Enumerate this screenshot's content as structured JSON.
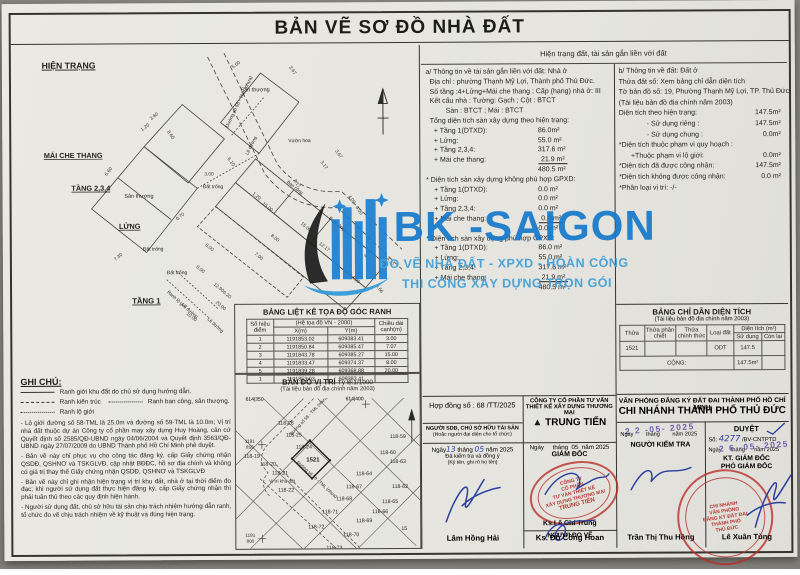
{
  "title": "BẢN VẼ SƠ ĐỒ NHÀ ĐẤT",
  "colors": {
    "paper": "#eae9e3",
    "ink": "#24241f",
    "watermark_blue": "#1679cc",
    "watermark_light": "#3f9ed8",
    "stamp_red": "#ba2a26",
    "pen_blue": "#2b3f9e",
    "date_purple": "#6e63b0"
  },
  "watermark": {
    "brand": "BK -SAIGON",
    "line1": "ĐO VẼ NHÀ ĐẤT - XPXD - HOÀN CÔNG",
    "line2": "THI CÔNG XÂY DỰNG TRỌN GÓI"
  },
  "info_header": "Hiện trạng đất, tài sản gắn liền với đất",
  "info_a": {
    "lines": [
      {
        "t": "a/ Thông tin về tài sản gắn liền với đất: Nhà ở",
        "ind": 0
      },
      {
        "t": "Địa chỉ : phường Thạnh Mỹ Lợi, Thành phố Thủ Đức.",
        "ind": 1
      },
      {
        "t": "Số tầng :4+Lửng+Mái che thang ; Cấp (hạng) nhà ở:  III",
        "ind": 1
      },
      {
        "t": "Kết cấu nhà : Tường:  Gạch    ; Cột :  BTCT",
        "ind": 1
      },
      {
        "t": "Sàn :  BTCT   ; Mái :  BTCT",
        "ind": 5
      },
      {
        "t": "Tổng diện tích sàn xây dựng theo hiện trạng:",
        "ind": 1
      },
      {
        "t": "+ Tầng 1(DTXD):",
        "v": "86.0m²",
        "ind": 2
      },
      {
        "t": "+ Lửng:",
        "v": "55.0 m²",
        "ind": 2
      },
      {
        "t": "+ Tầng 2,3,4:",
        "v": "317.6 m²",
        "ind": 2
      },
      {
        "t": "+ Mái che thang:",
        "v": "21.9 m²",
        "ind": 2,
        "vu": 1
      },
      {
        "t": "",
        "v": "480.5 m²",
        "ind": 2
      },
      {
        "t": "* Diện tích sàn xây dựng không phù hợp GPXD:",
        "ind": 0
      },
      {
        "t": "+ Tầng 1(DTXD):",
        "v": "0.0 m²",
        "ind": 2
      },
      {
        "t": "+ Lửng:",
        "v": "0.0 m²",
        "ind": 2
      },
      {
        "t": "+ Tầng 2,3,4:",
        "v": "0.0 m²",
        "ind": 2
      },
      {
        "t": "+ Mái che thang:",
        "v": "0.0 m²",
        "ind": 2,
        "vu": 1
      },
      {
        "t": "",
        "v": "0.0 m²",
        "ind": 2
      },
      {
        "t": "* Diện tích sàn xây dựng phù hợp GPXD:",
        "ind": 0
      },
      {
        "t": "+ Tầng 1(DTXD):",
        "v": "86.0 m²",
        "ind": 2
      },
      {
        "t": "+ Lửng:",
        "v": "55.0 m²",
        "ind": 2
      },
      {
        "t": "+ Tầng 2,3,4:",
        "v": "317.6 m²",
        "ind": 2
      },
      {
        "t": "+ Mái che thang:",
        "v": "21.9 m²",
        "ind": 2,
        "vu": 1
      },
      {
        "t": "",
        "v": "480.5 m²",
        "ind": 2
      }
    ]
  },
  "info_b": {
    "lines": [
      {
        "t": "b/ Thông tin về đất: Đất ở",
        "ind": 0
      },
      {
        "t": "Thửa đất số:  Xem bảng chỉ dẫn diện tích",
        "ind": 0
      },
      {
        "t": "Tờ bản đồ số:  19, Phường Thạnh Mỹ Lợi, TP. Thủ Đức.",
        "ind": 0
      },
      {
        "t": "(Tài liệu bản đồ địa chính năm 2003)",
        "ind": 0
      },
      {
        "t": "Diện tích theo hiện trạng:",
        "v": "147.5m²",
        "ind": 0
      },
      {
        "t": "- Sử dụng riêng :",
        "v": "147.5m²",
        "ind": 7
      },
      {
        "t": "- Sử dụng chung :",
        "v": "0.0m²",
        "ind": 7
      },
      {
        "t": "*Diện tích thuộc phạm vi quy hoạch :",
        "ind": 0
      },
      {
        "t": "+Thuộc phạm vi lộ giới:",
        "v": "0.0m²",
        "ind": 3
      },
      {
        "t": "*Diện tích đã được công nhận:",
        "v": "147.5m²",
        "ind": 0
      },
      {
        "t": "*Diện tích không được công nhận:",
        "v": "0.0 m²",
        "ind": 0
      },
      {
        "t": "*Phân loại vị trí:  -/-",
        "ind": 0
      }
    ]
  },
  "plan": {
    "heading": "HIỆN TRẠNG",
    "labels": [
      {
        "t": "HIỆN TRẠNG",
        "x": 14,
        "y": 56,
        "s": 9.5,
        "b": 1,
        "u": 1
      },
      {
        "t": "Sân thượng",
        "x": 232,
        "y": 82,
        "s": 6
      },
      {
        "t": "Sân thượng",
        "x": 104,
        "y": 198,
        "s": 6
      },
      {
        "t": "MÁI CHE THANG",
        "x": 16,
        "y": 154,
        "s": 8,
        "b": 1,
        "u": 1
      },
      {
        "t": "TẦNG 2,3,4",
        "x": 46,
        "y": 190,
        "s": 8,
        "b": 1,
        "u": 1
      },
      {
        "t": "LỬNG",
        "x": 98,
        "y": 232,
        "s": 8,
        "b": 1,
        "u": 1
      },
      {
        "t": "TẦNG 1",
        "x": 112,
        "y": 314,
        "s": 8.5,
        "b": 1,
        "u": 1
      },
      {
        "t": "Đất trống",
        "x": 190,
        "y": 188,
        "s": 5.5
      },
      {
        "t": "Đất trống",
        "x": 124,
        "y": 256,
        "s": 5.5
      },
      {
        "t": "Đất trống",
        "x": 150,
        "y": 282,
        "s": 5.5
      },
      {
        "t": "Vườn hoa",
        "x": 284,
        "y": 138,
        "s": 5.5
      },
      {
        "t": "Đường số 58 - TML (nhựa)",
        "x": 218,
        "y": 122,
        "s": 5.2,
        "r": -64
      },
      {
        "t": "Lề đường",
        "x": 240,
        "y": 152,
        "s": 5,
        "r": -64
      },
      {
        "t": "Ban công",
        "x": 282,
        "y": 182,
        "s": 5,
        "r": 40
      },
      {
        "t": "Ban công",
        "x": 328,
        "y": 222,
        "s": 5,
        "r": 40
      },
      {
        "t": "Ranh lộ giới",
        "x": 150,
        "y": 302,
        "s": 5,
        "r": 42
      },
      {
        "t": "Lề đường",
        "x": 166,
        "y": 316,
        "s": 5,
        "r": 42
      },
      {
        "t": "Lề đường",
        "x": 194,
        "y": 332,
        "s": 5,
        "r": 42
      }
    ],
    "dims": [
      {
        "t": "5.00",
        "x": 228,
        "y": 54,
        "r": -35
      },
      {
        "t": "3.67",
        "x": 288,
        "y": 60,
        "r": 55
      },
      {
        "t": "3.60",
        "x": 138,
        "y": 110,
        "r": -38
      },
      {
        "t": "1.20",
        "x": 128,
        "y": 122,
        "r": -38
      },
      {
        "t": "8.60",
        "x": 154,
        "y": 130,
        "r": 55
      },
      {
        "t": "6.60",
        "x": 88,
        "y": 170,
        "r": -52
      },
      {
        "t": "6.10",
        "x": 220,
        "y": 160,
        "r": 55
      },
      {
        "t": "3.00",
        "x": 197,
        "y": 174,
        "r": 0
      },
      {
        "t": "2.17",
        "x": 292,
        "y": 184,
        "r": 55
      },
      {
        "t": "0.70",
        "x": 166,
        "y": 220,
        "r": -38
      },
      {
        "t": "7.30",
        "x": 98,
        "y": 264,
        "r": -40
      },
      {
        "t": "1.20",
        "x": 248,
        "y": 198,
        "r": 40
      },
      {
        "t": "15.00",
        "x": 260,
        "y": 210,
        "r": 40
      },
      {
        "t": "3.17",
        "x": 322,
        "y": 164,
        "r": 55
      },
      {
        "t": "3.67",
        "x": 338,
        "y": 152,
        "r": 55
      },
      {
        "t": "4.00",
        "x": 352,
        "y": 202,
        "r": 55
      },
      {
        "t": "6.00",
        "x": 360,
        "y": 214,
        "r": 55
      },
      {
        "t": "8.00",
        "x": 268,
        "y": 244,
        "r": 40
      },
      {
        "t": "7.00",
        "x": 250,
        "y": 264,
        "r": 40
      },
      {
        "t": "12.17",
        "x": 322,
        "y": 254,
        "r": 40
      },
      {
        "t": "15.00",
        "x": 302,
        "y": 232,
        "r": 40
      },
      {
        "t": "4.40",
        "x": 372,
        "y": 262,
        "r": -40
      },
      {
        "t": "3.12",
        "x": 394,
        "y": 270,
        "r": 55
      },
      {
        "t": "6.66",
        "x": 382,
        "y": 300,
        "r": 55
      },
      {
        "t": "4.00",
        "x": 356,
        "y": 290,
        "r": 40
      },
      {
        "t": "8.00",
        "x": 196,
        "y": 254,
        "r": 40
      },
      {
        "t": "8.00",
        "x": 186,
        "y": 278,
        "r": 40
      },
      {
        "t": "12.90",
        "x": 206,
        "y": 298,
        "r": 40
      },
      {
        "t": "10.00",
        "x": 176,
        "y": 330,
        "r": 40
      },
      {
        "t": "6.20",
        "x": 215,
        "y": 306,
        "r": 40
      },
      {
        "t": "20.00",
        "x": 208,
        "y": 318,
        "r": 40
      }
    ]
  },
  "coord_table": {
    "title": "BẢNG LIỆT KÊ TỌA ĐỘ GÓC RANH",
    "col_point": "Số hiệu điểm",
    "col_sys": "(Hệ tọa độ VN - 2000)",
    "col_x": "X(m)",
    "col_y": "Y(m)",
    "col_len": "Chiều dài cạnh(m)",
    "rows": [
      [
        "1",
        "1191853.02",
        "609383.41",
        "3.00"
      ],
      [
        "2",
        "1191850.84",
        "609385.47",
        "7.07"
      ],
      [
        "3",
        "1191843.78",
        "609385.27",
        "15.00"
      ],
      [
        "4",
        "1191833.47",
        "609374.37",
        "8.00"
      ],
      [
        "5",
        "1191839.28",
        "609368.88",
        "20.00"
      ],
      [
        "1",
        "1191853.02",
        "609383.41",
        ""
      ]
    ]
  },
  "map": {
    "title": "BẢN ĐỒ VỊ TRÍ",
    "scale": "Tỷ lệ:1/1000",
    "subtitle": "(Tài liệu bản đồ địa chính năm 2003)",
    "ref_left": "614|350",
    "ref_right": "614|400",
    "labels": [
      {
        "t": "118-26",
        "x": 272,
        "y": 410
      },
      {
        "t": "118-25",
        "x": 280,
        "y": 422
      },
      {
        "t": "118-24",
        "x": 290,
        "y": 434
      },
      {
        "t": "1521",
        "x": 299,
        "y": 447,
        "b": 1,
        "s": 6
      },
      {
        "t": "118-19",
        "x": 238,
        "y": 443
      },
      {
        "t": "118-20",
        "x": 254,
        "y": 451
      },
      {
        "t": "118-21",
        "x": 266,
        "y": 460
      },
      {
        "t": "Vị trí khu đất",
        "x": 268,
        "y": 468,
        "s": 4.6
      },
      {
        "t": "118-22",
        "x": 272,
        "y": 477
      },
      {
        "t": "118-59",
        "x": 384,
        "y": 424
      },
      {
        "t": "118-60",
        "x": 374,
        "y": 440
      },
      {
        "t": "118-63",
        "x": 384,
        "y": 449
      },
      {
        "t": "118-64",
        "x": 350,
        "y": 461
      },
      {
        "t": "118-67",
        "x": 340,
        "y": 474
      },
      {
        "t": "118-68",
        "x": 330,
        "y": 486
      },
      {
        "t": "118-62",
        "x": 386,
        "y": 474
      },
      {
        "t": "118-65",
        "x": 376,
        "y": 489
      },
      {
        "t": "118-66",
        "x": 366,
        "y": 499
      },
      {
        "t": "118-69",
        "x": 350,
        "y": 508
      },
      {
        "t": "118-71",
        "x": 316,
        "y": 499
      },
      {
        "t": "118-72",
        "x": 302,
        "y": 514
      },
      {
        "t": "118-70",
        "x": 337,
        "y": 522
      },
      {
        "t": "118-73",
        "x": 320,
        "y": 535
      },
      {
        "t": "15",
        "x": 390,
        "y": 516
      },
      {
        "t": "1191",
        "x": 236,
        "y": 428,
        "s": 4.6
      },
      {
        "t": "850",
        "x": 236,
        "y": 434,
        "s": 4.6
      },
      {
        "t": "1191",
        "x": 236,
        "y": 522,
        "s": 4.6
      },
      {
        "t": "800",
        "x": 236,
        "y": 528,
        "s": 4.6
      },
      {
        "t": "Đường số 58 - TML (nhựa)",
        "x": 296,
        "y": 402,
        "s": 4.4,
        "r": -46
      },
      {
        "t": "Đường số 59 - TML (nhựa)",
        "x": 302,
        "y": 466,
        "s": 4.4,
        "r": 43
      }
    ]
  },
  "notes": {
    "heading": "GHI CHÚ:",
    "legend": [
      {
        "label": "Ranh giới khu đất do chủ sử dụng hướng dẫn."
      },
      {
        "label": "Ranh kiến trúc"
      },
      {
        "label": "Ranh ban công, sân thượng."
      },
      {
        "label": "Ranh lộ giới"
      }
    ],
    "paragraphs": [
      "- Lộ giới đường số 58-TML là 25.0m và đường số 59-TML là 10.0m; Vị trí nhà đất thuộc dự án Công ty cổ phần may xây dựng Huy Hoàng, căn cứ Quyết định số 2585/QĐ-UBND ngày 04/06/2004 và Quyết định 3563/QĐ-UBND ngày 27/07/2009 do UBND Thành phố Hồ Chí Minh phê duyệt.",
      "- Bản vẽ này chỉ phục vụ cho công tác đăng ký, cấp Giấy chứng nhận QSDĐ, QSHNƠ và TSKGLVĐ, cập nhật BĐĐC, hồ sơ địa chính và không có giá trị thay thế Giấy chứng nhận QSDĐ, QSHNƠ và TSKGLVĐ",
      "- Bản vẽ này chỉ ghi nhận hiện trạng vị trí khu đất, nhà ở tại thời điểm đo đạc; khi người sử dụng đất thực hiện đăng ký, cấp Giấy chứng nhận thì phải tuân thủ theo các quy định hiện hành.",
      "- Người sử dụng đất, chủ sở hữu tài sản chịu trách nhiệm hướng dẫn ranh, tổ chức đo vẽ chịu trách nhiệm về kỹ thuật và đúng hiện trạng."
    ]
  },
  "area_table": {
    "title": "BẢNG CHỈ DẪN DIỆN TÍCH",
    "subtitle": "(Tài liệu bản đồ địa chính năm 2003)",
    "col_thua": "Thửa",
    "col_phanchiet": "Thửa phân chiết",
    "col_chinhthuc": "Thửa chính thức",
    "col_loaidat": "Loại đất",
    "col_dientich": "Diện tích (m²)",
    "col_sudung": "Sử dụng",
    "col_conlai": "Còn lại",
    "row": [
      "1521",
      "",
      "",
      "ODT",
      "147.5",
      ""
    ],
    "cong_label": "CỘNG:",
    "cong_value": "147.5m²"
  },
  "contract_label": "Hợp đồng số : 68 /TT/2025",
  "company": {
    "l1": "CÔNG TY CỔ PHẦN TƯ VẤN",
    "l2": "THIẾT KẾ XÂY DỰNG THƯƠNG MẠI",
    "brand": "TRUNG TIẾN"
  },
  "owner_sign": {
    "header1": "NGƯỜI SDĐ, CHỦ SỞ HỮU TÀI SẢN",
    "header2": "(Hoặc người đại diện cho tổ chức)",
    "date_pre": "Ngày",
    "d": "13",
    "m_label": "tháng",
    "m": "05",
    "y_label": "năm 2025",
    "note1": "Đã kiểm tra và đồng ý",
    "note2": "(Ký tên, ghi rõ họ tên)",
    "name": "Lâm Hồng Hải"
  },
  "company_sign": {
    "date_line": "Ngày     tháng  05  năm 2025",
    "role1": "GIÁM ĐỐC",
    "name1": "Ks.Lê Chí Trung",
    "role2": "NGƯỜI ĐO VẼ",
    "name2": "Ks. Đỗ Công Hoan",
    "stamp_lines": [
      "CÔNG TY",
      "CỔ PHẦN",
      "TƯ VẤN THIẾT KẾ",
      "XÂY DỰNG THƯƠNG MẠI",
      "TRUNG TIẾN"
    ]
  },
  "office": {
    "title1": "VĂN PHÒNG ĐĂNG KÝ ĐẤT ĐAI THÀNH PHỐ HỒ CHÍ MINH",
    "title2": "CHI NHÁNH THÀNH PHỐ THỦ ĐỨC",
    "left": {
      "date_stamp": "2 2 -05- 2025",
      "date_line": "Ngày        tháng        năm 2025",
      "role": "NGƯỜI KIỂM TRA",
      "name": "Trần Thị Thu Hồng"
    },
    "right": {
      "approve": "DUYỆT",
      "so_label": "Số:",
      "so_value": "4277",
      "so_suffix": "/BV-CNTPTD",
      "date_stamp": "2 6 -05- 2025",
      "date_line": "Ngày      tháng      năm 2025",
      "role1": "KT. GIÁM ĐỐC",
      "role2": "PHÓ GIÁM ĐỐC",
      "name": "Lê Xuân Tùng",
      "stamp_lines": [
        "CHI NHÁNH",
        "VĂN PHÒNG",
        "ĐĂNG KÝ ĐẤT ĐAI",
        "THÀNH PHỐ",
        "THỦ ĐỨC"
      ]
    }
  }
}
